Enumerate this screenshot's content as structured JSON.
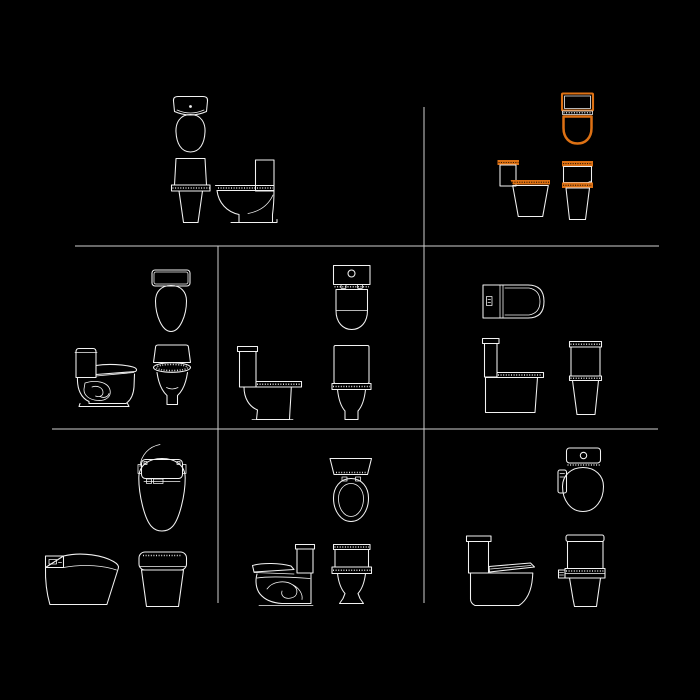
{
  "canvas": {
    "width": 700,
    "height": 700,
    "background": "#000000"
  },
  "colors": {
    "background": "#000000",
    "line": "#f2f2f2",
    "grid": "#cfcfcf",
    "highlight": "#dd7114"
  },
  "grid": {
    "h_lines": [
      {
        "x1": 75,
        "y": 246,
        "x2": 659
      },
      {
        "x1": 52,
        "y": 429,
        "x2": 658
      }
    ],
    "v_lines": [
      {
        "x": 218,
        "y1": 246,
        "y2": 603
      },
      {
        "x": 424,
        "y1": 107,
        "y2": 603
      }
    ]
  },
  "blocks": [
    {
      "id": "toilet-block-top-left",
      "cell": "row-1-col-left",
      "highlighted": false,
      "views": [
        "plan",
        "front",
        "side"
      ]
    },
    {
      "id": "toilet-block-top-right",
      "cell": "row-1-col-right",
      "highlighted": true,
      "views": [
        "plan",
        "side",
        "front"
      ]
    },
    {
      "id": "toilet-block-mid-left",
      "cell": "row-2-col-1",
      "highlighted": false,
      "views": [
        "plan",
        "side",
        "front"
      ]
    },
    {
      "id": "toilet-block-mid-center",
      "cell": "row-2-col-2",
      "highlighted": false,
      "views": [
        "plan",
        "side",
        "front"
      ]
    },
    {
      "id": "toilet-block-mid-right",
      "cell": "row-2-col-3",
      "highlighted": false,
      "views": [
        "plan",
        "side",
        "front"
      ]
    },
    {
      "id": "toilet-block-bottom-left",
      "cell": "row-3-col-1",
      "highlighted": false,
      "views": [
        "plan",
        "side",
        "front"
      ]
    },
    {
      "id": "toilet-block-bottom-center",
      "cell": "row-3-col-2",
      "highlighted": false,
      "views": [
        "plan",
        "side",
        "front"
      ]
    },
    {
      "id": "toilet-block-bottom-right",
      "cell": "row-3-col-3",
      "highlighted": false,
      "views": [
        "plan",
        "side",
        "front"
      ]
    }
  ]
}
